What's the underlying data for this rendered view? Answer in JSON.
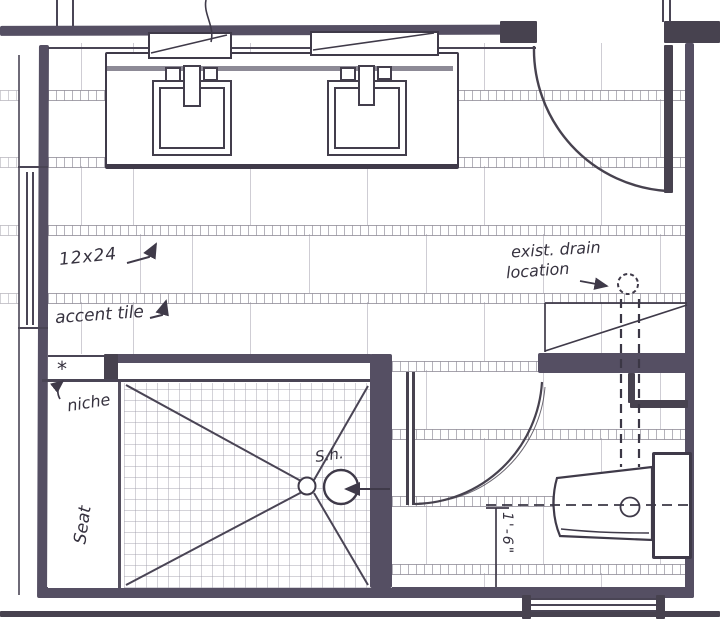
{
  "drawing_title": "bathroom plan sketch",
  "annotations": {
    "tile_size": "12x24",
    "accent_tile": "accent tile",
    "exist_drain_line1": "exist. drain",
    "exist_drain_line2": "location",
    "niche_label": "niche",
    "niche_marker": "*",
    "seat_label": "Seat",
    "shower_head_label": "S.h.",
    "toilet_offset_dimension": "1'-6\""
  },
  "colors": {
    "ink": "#3f3a49",
    "wall_fill": "#554f63",
    "wall_dark": "#47424f",
    "counter_line": "#8d8a96",
    "tile_line": "#b0adb8",
    "paper": "#ffffff"
  }
}
